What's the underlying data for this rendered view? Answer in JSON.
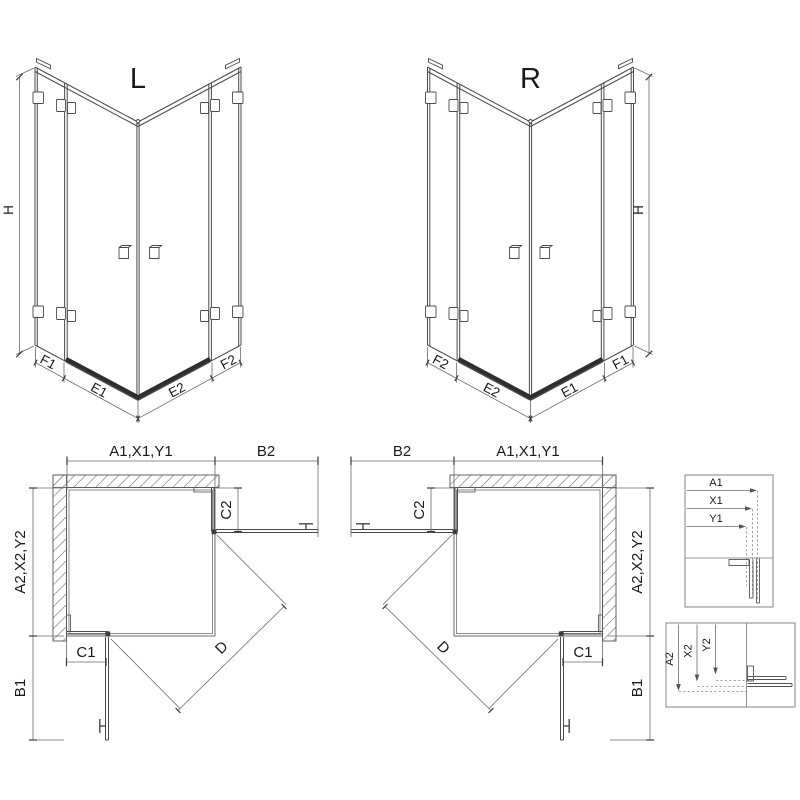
{
  "colors": {
    "line": "#4a4a4a",
    "thin_line": "#6a6a6a",
    "hatch": "#9a9a9a",
    "threshold": "#2e2e2e",
    "text": "#1a1a1a",
    "background": "#ffffff"
  },
  "iso_left": {
    "title": "L",
    "height_label": "H",
    "bottom_labels": [
      "F1",
      "E1",
      "E2",
      "F2"
    ]
  },
  "iso_right": {
    "title": "R",
    "height_label": "H",
    "bottom_labels": [
      "F2",
      "E2",
      "E1",
      "F1"
    ]
  },
  "plan_left": {
    "top_width_label": "A1,X1,Y1",
    "return_top_label": "B2",
    "depth_label": "A2,X2,Y2",
    "return_side_label": "B1",
    "fixed_top_label": "C2",
    "fixed_side_label": "C1",
    "diagonal_label": "D"
  },
  "plan_right": {
    "top_width_label": "A1,X1,Y1",
    "return_top_label": "B2",
    "depth_label": "A2,X2,Y2",
    "return_side_label": "B1",
    "fixed_top_label": "C2",
    "fixed_side_label": "C1",
    "diagonal_label": "D"
  },
  "detail_top": {
    "labels": [
      "A1",
      "X1",
      "Y1"
    ]
  },
  "detail_bottom": {
    "labels": [
      "A2",
      "X2",
      "Y2"
    ]
  }
}
